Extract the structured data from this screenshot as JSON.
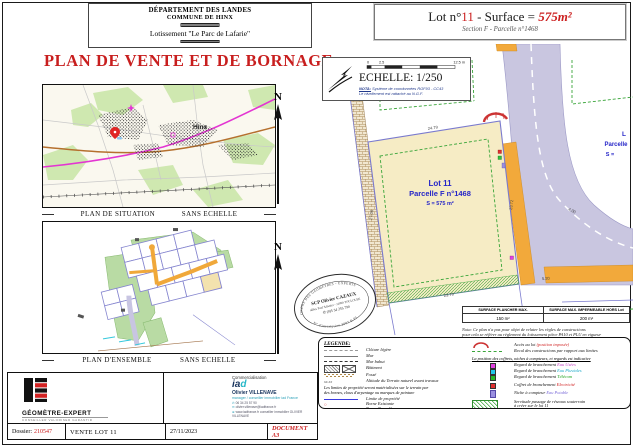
{
  "header": {
    "dept": "DÉPARTEMENT DES LANDES",
    "commune": "COMMUNE DE HINX",
    "lotissement": "Lotissement  \"Le Parc de Lafarie\"",
    "title": "PLAN DE VENTE ET DE BORNAGE"
  },
  "lot_box": {
    "prefix": "Lot n°",
    "number": "11",
    "mid": " - Surface = ",
    "value": "575m²",
    "sub": "Section F - Parcelle n°1468"
  },
  "situation": {
    "caption": "PLAN DE SITUATION",
    "scale_note": "SANS ECHELLE",
    "town": "Hinx",
    "north_letter": "N"
  },
  "ensemble": {
    "caption": "PLAN D'ENSEMBLE",
    "scale_note": "SANS ECHELLE",
    "north_letter": "N"
  },
  "scale_box": {
    "title": "ECHELLE: 1/250",
    "tick0": "0",
    "tick1": "2.5",
    "tick2": "12.5 m",
    "nota_label": "NOTA:",
    "nota1": "Système de coordonnées RGF93 - CC43",
    "nota2": "Le nivellement est rattaché au N.G.F."
  },
  "plan": {
    "lot": "Lot 11",
    "parcelle": "Parcelle F n°1468",
    "surface": "S = 575 m²",
    "neighbor_l1": "L",
    "neighbor_l2": "Parcelle",
    "neighbor_l3": "S =",
    "dim_top": "24.79",
    "dim_left": "27.06",
    "dim_right": "23.72",
    "dim_bottom": "23.79",
    "dim_road": "5.20",
    "dim_diag": "4.00",
    "table_h1": "SURFACE PLANCHER MAX.",
    "table_h2": "SURFACE MAX. IMPERMEABLE HORS Lot",
    "table_v1": "150 m²",
    "table_v2": "200 m²",
    "nota_l1": "Nota: Ce plan n'a pas pour objet de relater les règles de constructions",
    "nota_l2": "pour cela se référer au règlement du lotissement pièce PA10 et PLU en vigueur"
  },
  "stamp": {
    "arc_top": "ORDRE DES GÉOMÈTRES - EXPERTS",
    "name": "SCP Olivier CAZAUX",
    "address": "allées Paul Sabatier - 31000 TOULOUSE",
    "phone": "✆ (0)5 34 255 790",
    "arc_bottom": "N° d'inscription 2007 B 05"
  },
  "legend": {
    "title": "LEGENDE:",
    "cloture": "Clôture légère",
    "mur": "Mur",
    "mur_bahut": "Mur bahut",
    "batiment": "Bâtiment",
    "fosse": "Fossé",
    "altitude_sym": "xx.xx",
    "altitude": "Altitude du Terrain naturel avant travaux",
    "note1": "Les limites de propriété seront matérialisées sur le terrain par",
    "note2": "des bornes, clous d'arpentage ou marques de peinture",
    "limite": "Limite de propriété",
    "borne1": "Borne Existante",
    "borne2": "Borne Nouvelle",
    "borne3": "Clou d'Arpentage",
    "borne4": "Marque Peinture",
    "sym_borne1": "○",
    "sym_borne2": "□",
    "sym_borne3": "+",
    "sym_borne4": "╱",
    "acces": "Accès au lot ",
    "acces_red": "(position imposée)",
    "recul": "Recul des constructions par rapport aux limites",
    "coffrets": "La position des coffrets, niches à compteurs, et regards est indicative",
    "regard_prefix": "Regard de branchement ",
    "eau_usees": "Eau Usées",
    "eau_pluviales": "Eau Pluviales",
    "telecom": "Télécom",
    "coffret_prefix": "Coffret de branchement ",
    "electricite": "Electricité",
    "niche_prefix": "Niche à compteur ",
    "eau_potable": "Eau Potable",
    "servitude1": "Servitude passage de réseaux souterrain",
    "servitude2": "à créer sur le lot 11",
    "servitude3": "S=22m²"
  },
  "footer": {
    "brand": "GÉOMÈTRE-EXPERT",
    "tagline": "CONSEILLER VALORISER GARANTIR",
    "commercialisation": "Commercialisation",
    "iad_i": "ia",
    "iad_d": "d",
    "agent": "Olivier VILLENAVE",
    "role": "manager / conseiller immobilier iad France",
    "phone_icon": "✆",
    "phone": "06 34 25 57 90",
    "mail_icon": "✉",
    "email": "olivier.villenave@iadfrance.fr",
    "web_icon": "⊕",
    "web": "www.iadfrance.fr  conseiller immobilier OLIVIER VILLENAVE",
    "dossier_label": "Dossier:",
    "dossier": "210547",
    "doc": "VENTE LOT 11",
    "date": "27/11/2023",
    "format": "DOCUMENT A3"
  },
  "colors": {
    "title_red": "#c81e1e",
    "parcel_fill": "#f6ecc5",
    "road_fill": "#c9c6e0",
    "sidewalk_orange": "#f2a93b",
    "setback_green": "#3aa53a",
    "boundary_blue": "#7a7ace",
    "lot_text_blue": "#2626c8",
    "route_magenta": "#e335d2"
  }
}
